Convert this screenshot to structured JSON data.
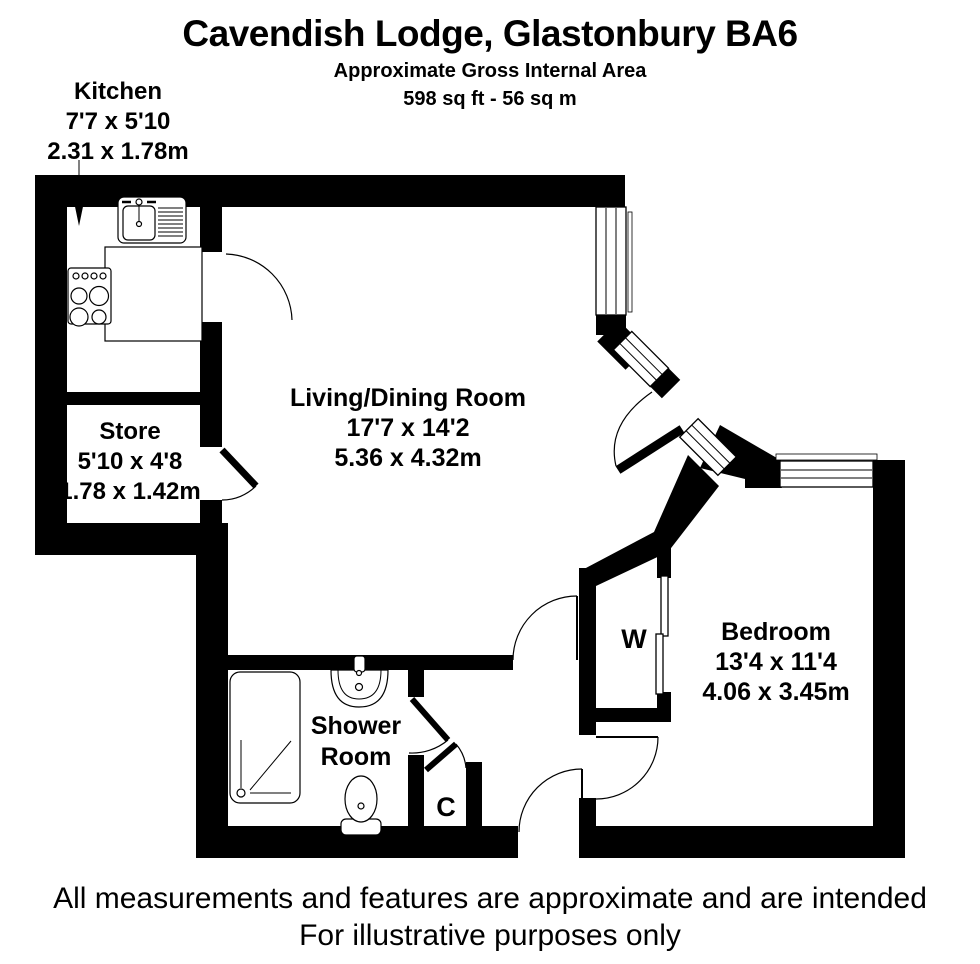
{
  "header": {
    "title": "Cavendish Lodge, Glastonbury BA6",
    "subtitle": "Approximate Gross Internal Area",
    "area": "598 sq ft - 56 sq m"
  },
  "rooms": {
    "kitchen": {
      "name": "Kitchen",
      "imperial": "7'7 x 5'10",
      "metric": "2.31 x 1.78m"
    },
    "store": {
      "name": "Store",
      "imperial": "5'10 x 4'8",
      "metric": "1.78 x 1.42m"
    },
    "living_dining": {
      "name": "Living/Dining Room",
      "imperial": "17'7 x 14'2",
      "metric": "5.36 x 4.32m"
    },
    "bedroom": {
      "name": "Bedroom",
      "imperial": "13'4 x 11'4",
      "metric": "4.06 x 3.45m"
    },
    "shower_room": {
      "line1": "Shower",
      "line2": "Room"
    },
    "wardrobe": {
      "label": "W"
    },
    "cupboard": {
      "label": "C"
    }
  },
  "footer": {
    "line1": "All measurements and features are approximate and are intended",
    "line2": "For illustrative purposes only"
  },
  "colors": {
    "wall": "#000000",
    "background": "#ffffff",
    "text": "#000000"
  }
}
